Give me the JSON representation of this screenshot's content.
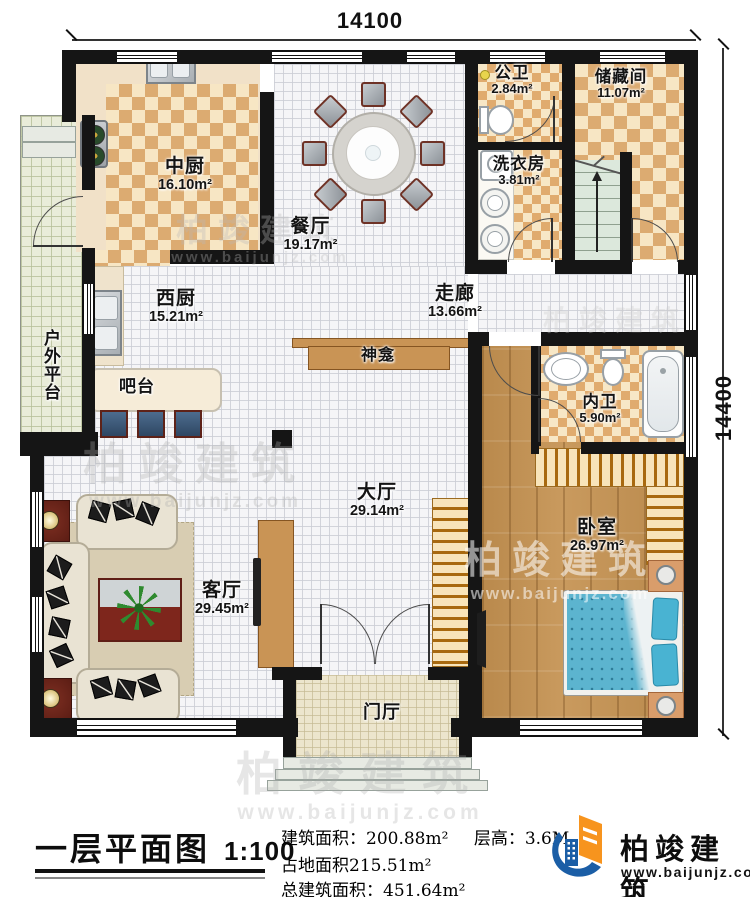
{
  "meta": {
    "title": "一层平面图",
    "scale": "1:100"
  },
  "dimensions": {
    "top": "14100",
    "right": "14400"
  },
  "rooms": {
    "zhongchu": {
      "name": "中厨",
      "area": "16.10m²"
    },
    "canting": {
      "name": "餐厅",
      "area": "19.17m²"
    },
    "gongwei": {
      "name": "公卫",
      "area": "2.84m²"
    },
    "chucang": {
      "name": "储藏间",
      "area": "11.07m²"
    },
    "xiyi": {
      "name": "洗衣房",
      "area": "3.81m²"
    },
    "xichu": {
      "name": "西厨",
      "area": "15.21m²"
    },
    "zoulang": {
      "name": "走廊",
      "area": "13.66m²"
    },
    "shenkan": {
      "name": "神龛"
    },
    "batai": {
      "name": "吧台"
    },
    "huwai": {
      "name": "户外平台"
    },
    "neiwei": {
      "name": "内卫",
      "area": "5.90m²"
    },
    "dating": {
      "name": "大厅",
      "area": "29.14m²"
    },
    "keting": {
      "name": "客厅",
      "area": "29.45m²"
    },
    "woshi": {
      "name": "卧室",
      "area": "26.97m²"
    },
    "menting": {
      "name": "门厅"
    }
  },
  "info": {
    "line1a": "建筑面积：200.88m²",
    "line1b": "层高：3.6M",
    "line2": "占地面积215.51m²",
    "line3": "总建筑面积：451.64m²"
  },
  "brand": {
    "name": "柏竣建筑",
    "website": "www.baijunjz.com"
  },
  "watermark": {
    "text": "柏竣建筑",
    "url": "www.baijunjz.com"
  },
  "colors": {
    "wall": "#151515",
    "checker": "#dcab71",
    "brand_blue": "#1b5ea6",
    "brand_orange": "#f7941e",
    "bed": "#5cb4cf"
  }
}
